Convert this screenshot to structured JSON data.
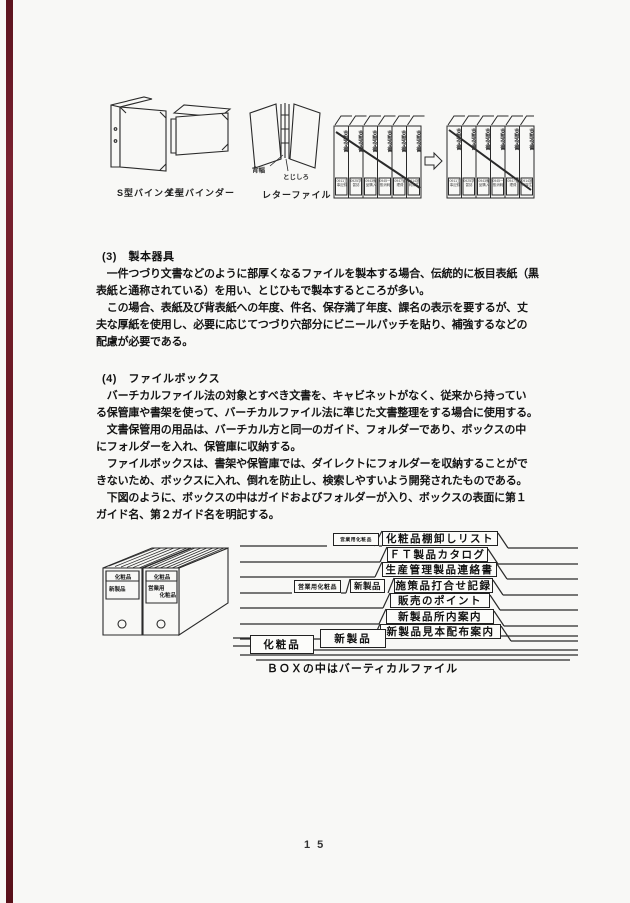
{
  "page_number": "15",
  "equipment_figure": {
    "binder_s_label": "S型バインダー",
    "binder_e_label": "E型バインダー",
    "letter_file_label": "レターファイル",
    "spine_width_label": "背幅",
    "binding_margin_label": "とじしろ",
    "spine_title": "支部令書",
    "spine_tags": [
      "0911工事記録",
      "0925学習誌",
      "0943備品購入",
      "0945一般消耗",
      "0947管理費",
      "0914福利厚生"
    ]
  },
  "section3": {
    "heading": "(3)　製本器具",
    "lines": [
      "　一件つづり文書などのように部厚くなるファイルを製本する場合、伝統的に板目表紙（黒",
      "表紙と通称されている）を用い、とじひもで製本するところが多い。",
      "　この場合、表紙及び背表紙への年度、件名、保存満了年度、課名の表示を要するが、丈",
      "夫な厚紙を使用し、必要に応じてつづり穴部分にビニールパッチを貼り、補強するなどの",
      "配慮が必要である。"
    ]
  },
  "section4": {
    "heading": "(4)　ファイルボックス",
    "lines": [
      "　バーチカルファイル法の対象とすべき文書を、キャビネットがなく、従来から持ってい",
      "る保管庫や書架を使って、バーチカルファイル法に準じた文書整理をする場合に使用する。",
      "　文書保管用の用品は、バーチカル方と同一のガイド、フォルダーであり、ボックスの中",
      "にフォルダーを入れ、保管庫に収納する。",
      "　ファイルボックスは、書架や保管庫では、ダイレクトにフォルダーを収納することがで",
      "きないため、ボックスに入れ、倒れを防止し、検索しやすいよう開発されたものである。",
      "　下図のように、ボックスの中はガイドおよびフォルダーが入り、ボックスの表面に第１",
      "ガイド名、第２ガイド名を明記する。"
    ]
  },
  "box_figure": {
    "box1_header": "化粧品",
    "box1_label": "新製品",
    "box2_header": "化粧品",
    "box2_label_line1": "営業用",
    "box2_label_line2": "化粧品",
    "small_tab": "営業用化粧品",
    "guide1": "営業用化粧品",
    "guide1_sub": "新製品",
    "guide2": "化粧品",
    "guide2_sub": "新製品",
    "folders": [
      "化粧品棚卸しリスト",
      "ＦＴ製品カタログ",
      "生産管理製品連絡書",
      "施策品打合せ記録",
      "販売のポイント",
      "新製品所内案内",
      "新製品見本配布案内"
    ],
    "caption": "ＢＯＸの中はバーティカルファイル"
  }
}
